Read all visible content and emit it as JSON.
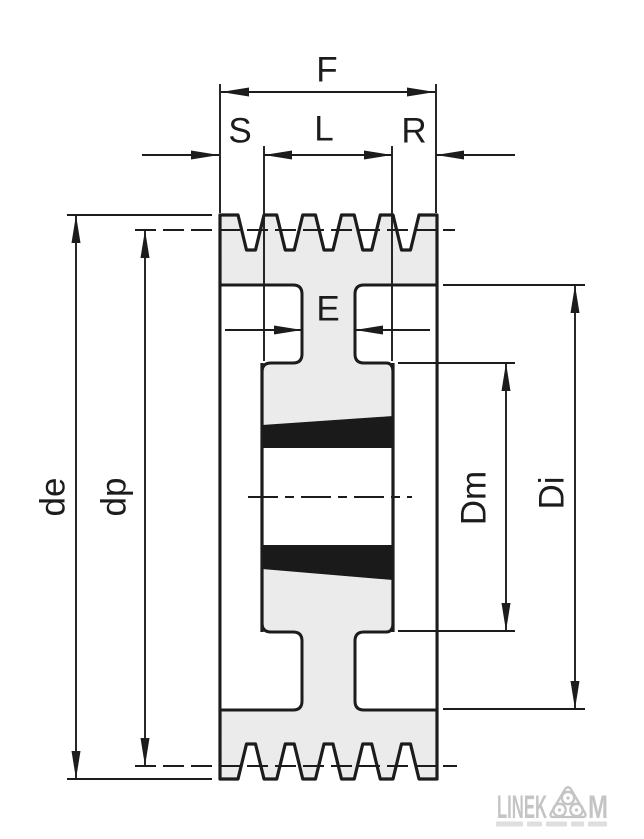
{
  "drawing": {
    "kind": "technical cross-section drawing",
    "subject": "V-belt pulley with taper bushing hub",
    "groove_count": 5
  },
  "labels": {
    "F": "F",
    "S": "S",
    "L": "L",
    "R": "R",
    "E": "E",
    "de": "de",
    "dp": "dp",
    "Dm": "Dm",
    "Di": "Di"
  },
  "dimension_meaning": {
    "F": "total rim face width (outer extension lines, top)",
    "S": "rim edge to hub face, left",
    "L": "hub / bushing length",
    "R": "rim edge to hub face, right",
    "E": "web thickness",
    "de": "outside diameter (left outer vertical dimension)",
    "dp": "pitch diameter (left inner vertical dimension, dashed datum)",
    "Dm": "hub diameter (right inner vertical dimension)",
    "Di": "rim inner diameter (right outer vertical dimension)"
  },
  "logo": {
    "brand": "LINEKOM",
    "brand_left": "LINEK",
    "brand_right": "M",
    "icon": "three-roller-triangle"
  },
  "colors": {
    "line": "#1c1c1c",
    "body_fill": "#ebebeb",
    "bushing_fill": "#1a1a1a",
    "bore_fill": "#ffffff",
    "logo_gray": "#c4c4c4",
    "background": "#ffffff"
  }
}
